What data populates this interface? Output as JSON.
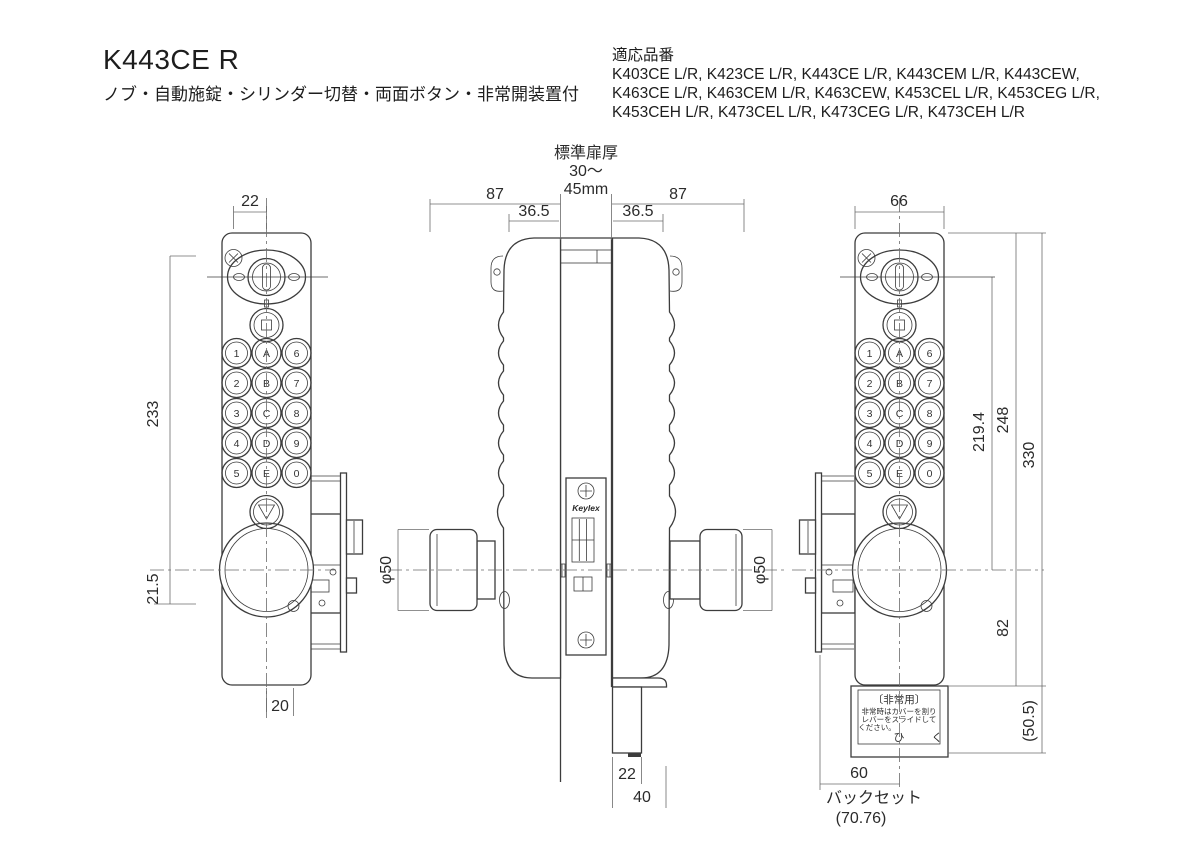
{
  "header": {
    "model": "K443CE R",
    "features": "ノブ・自動施錠・シリンダー切替・両面ボタン・非常開装置付",
    "applicable_label": "適応品番",
    "applicable_lines": [
      "K403CE L/R, K423CE L/R, K443CE L/R, K443CEM L/R, K443CEW,",
      "K463CE L/R, K463CEM L/R, K463CEW, K453CEL L/R, K453CEG L/R,",
      "K453CEH L/R, K473CEL L/R, K473CEG L/R, K473CEH L/R"
    ]
  },
  "brand_logo": "Keylex",
  "keypad": {
    "labels": [
      "1",
      "A",
      "6",
      "2",
      "B",
      "7",
      "3",
      "C",
      "8",
      "4",
      "D",
      "9",
      "5",
      "E",
      "0"
    ]
  },
  "dims": {
    "left": {
      "top": "22",
      "body": "233",
      "lower": "21.5",
      "bottom": "20"
    },
    "middle": {
      "thickness_title": "標準扉厚",
      "thickness_range": "30〜",
      "thickness_unit": "45mm",
      "depth_left": "87",
      "inner_left": "36.5",
      "inner_right": "36.5",
      "depth_right": "87",
      "knob_left": "φ50",
      "knob_right": "φ50",
      "bottom_inner": "22",
      "bottom_outer": "40"
    },
    "right": {
      "width": "66",
      "h_cyl_to_knob": "219.4",
      "h_top_to_knob": "248",
      "h_total": "330",
      "h_knob_to_bottom": "82",
      "h_box": "(50.5)",
      "backset": "60",
      "backset_label": "バックセット",
      "backset_actual": "(70.76)"
    }
  },
  "emergency": {
    "title": "〔非常用〕",
    "line1": "非常時はカバーを割り",
    "line2": "レバーをスライドして",
    "line3": "ください。",
    "pull": "ひ　く"
  }
}
